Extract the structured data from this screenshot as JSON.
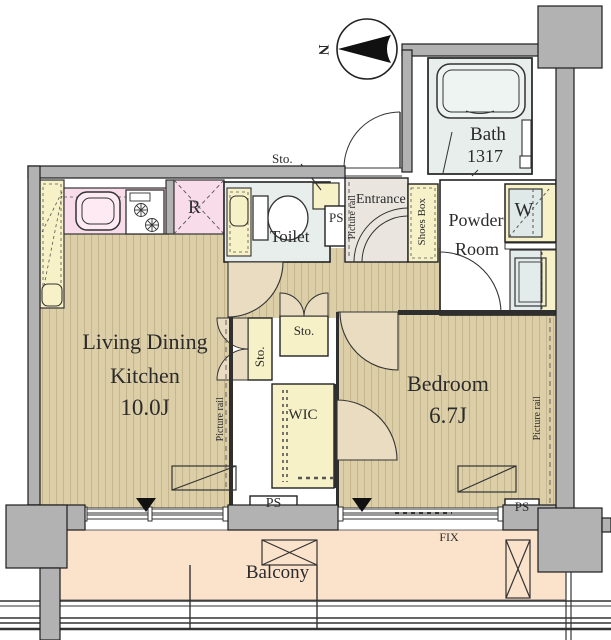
{
  "compass": {
    "north": "N"
  },
  "rooms": {
    "bath": {
      "name": "Bath",
      "size": "1317"
    },
    "powder": {
      "line1": "Powder",
      "line2": "Room"
    },
    "entrance": {
      "name": "Entrance"
    },
    "toilet": {
      "name": "Toilet"
    },
    "ldk": {
      "line1": "Living Dining",
      "line2": "Kitchen",
      "size": "10.0J"
    },
    "bedroom": {
      "name": "Bedroom",
      "size": "6.7J"
    },
    "wic": {
      "name": "WIC"
    },
    "balcony": {
      "name": "Balcony"
    }
  },
  "labels": {
    "shoes_box": "Shoes Box",
    "picture_rail": "Picture rail",
    "storage": "Sto.",
    "pipe_space": "PS",
    "washing_machine": "W",
    "refrigerator": "R",
    "fixed_window": "FIX"
  },
  "colors": {
    "wood_floor": "#dccfa8",
    "wood_stripe": "#ab9a6e",
    "balcony_floor": "#fbe2cb",
    "cabinet_yellow": "#f6f1c6",
    "counter_pink": "#f9dce9",
    "wet_area_green": "#e7eeec",
    "entrance_tile": "#eae5df",
    "wall_gray": "#b2b2b2",
    "door_leaf_beige": "#e9dcc0",
    "line_dark": "#2a2a2a"
  }
}
